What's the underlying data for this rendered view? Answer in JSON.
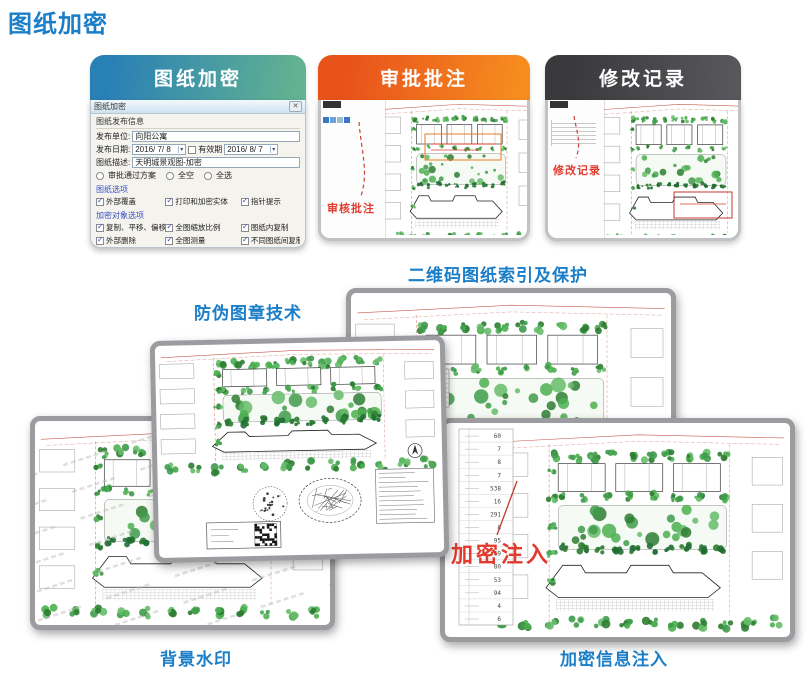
{
  "page": {
    "title": "图纸加密"
  },
  "cards": [
    {
      "title": "图纸加密"
    },
    {
      "title": "审批批注",
      "annotation": "审核批注"
    },
    {
      "title": "修改记录",
      "annotation": "修改记录"
    }
  ],
  "dialog": {
    "title": "图纸加密",
    "close": "✕",
    "group_title": "图纸发布信息",
    "unit_label": "发布单位:",
    "unit_value": "向阳公寓",
    "date_label": "发布日期:",
    "date_value": "2016/ 7/ 8",
    "valid_label": "有效期",
    "valid_value": "2016/ 8/ 7",
    "desc_label": "图纸描述:",
    "desc_value": "天明城景观图-加密",
    "radios": [
      "审批通过方案",
      "全空",
      "全选"
    ],
    "sections": [
      {
        "title": "图纸选项",
        "options": [
          "外部覆盖",
          "打印和加密实体",
          "指针提示"
        ]
      },
      {
        "title": "加密对象选项",
        "options": [
          "复制、平移、偏移",
          "全图缩放比例",
          "图纸内复制",
          "外部删除",
          "全图测量",
          "不同图纸间复制",
          "外部打印",
          "全图编辑",
          "外部分解"
        ]
      }
    ]
  },
  "labels": {
    "qr_index": "二维码图纸索引及保护",
    "stamp": "防伪图章技术",
    "watermark": "背景水印",
    "inject": "加密信息注入"
  },
  "sheets": {
    "inject_annotation": "加密注入",
    "plant_numbers": [
      "60",
      "7",
      "8",
      "7",
      "538",
      "16",
      "291",
      "8",
      "95",
      "69",
      "80",
      "53",
      "94",
      "4",
      "6"
    ]
  },
  "icons": {
    "check": "✓",
    "dropdown": "▾"
  },
  "colors": {
    "title_blue": "#1a7ec8",
    "card1_gradient": [
      "#2980b5",
      "#63b291"
    ],
    "card2_gradient": [
      "#e8531c",
      "#f78d1e"
    ],
    "card3_gradient": [
      "#3a3a3d",
      "#58585c"
    ],
    "annotation_red": "#e23b2e",
    "tree_green": "#3f9b4a"
  }
}
